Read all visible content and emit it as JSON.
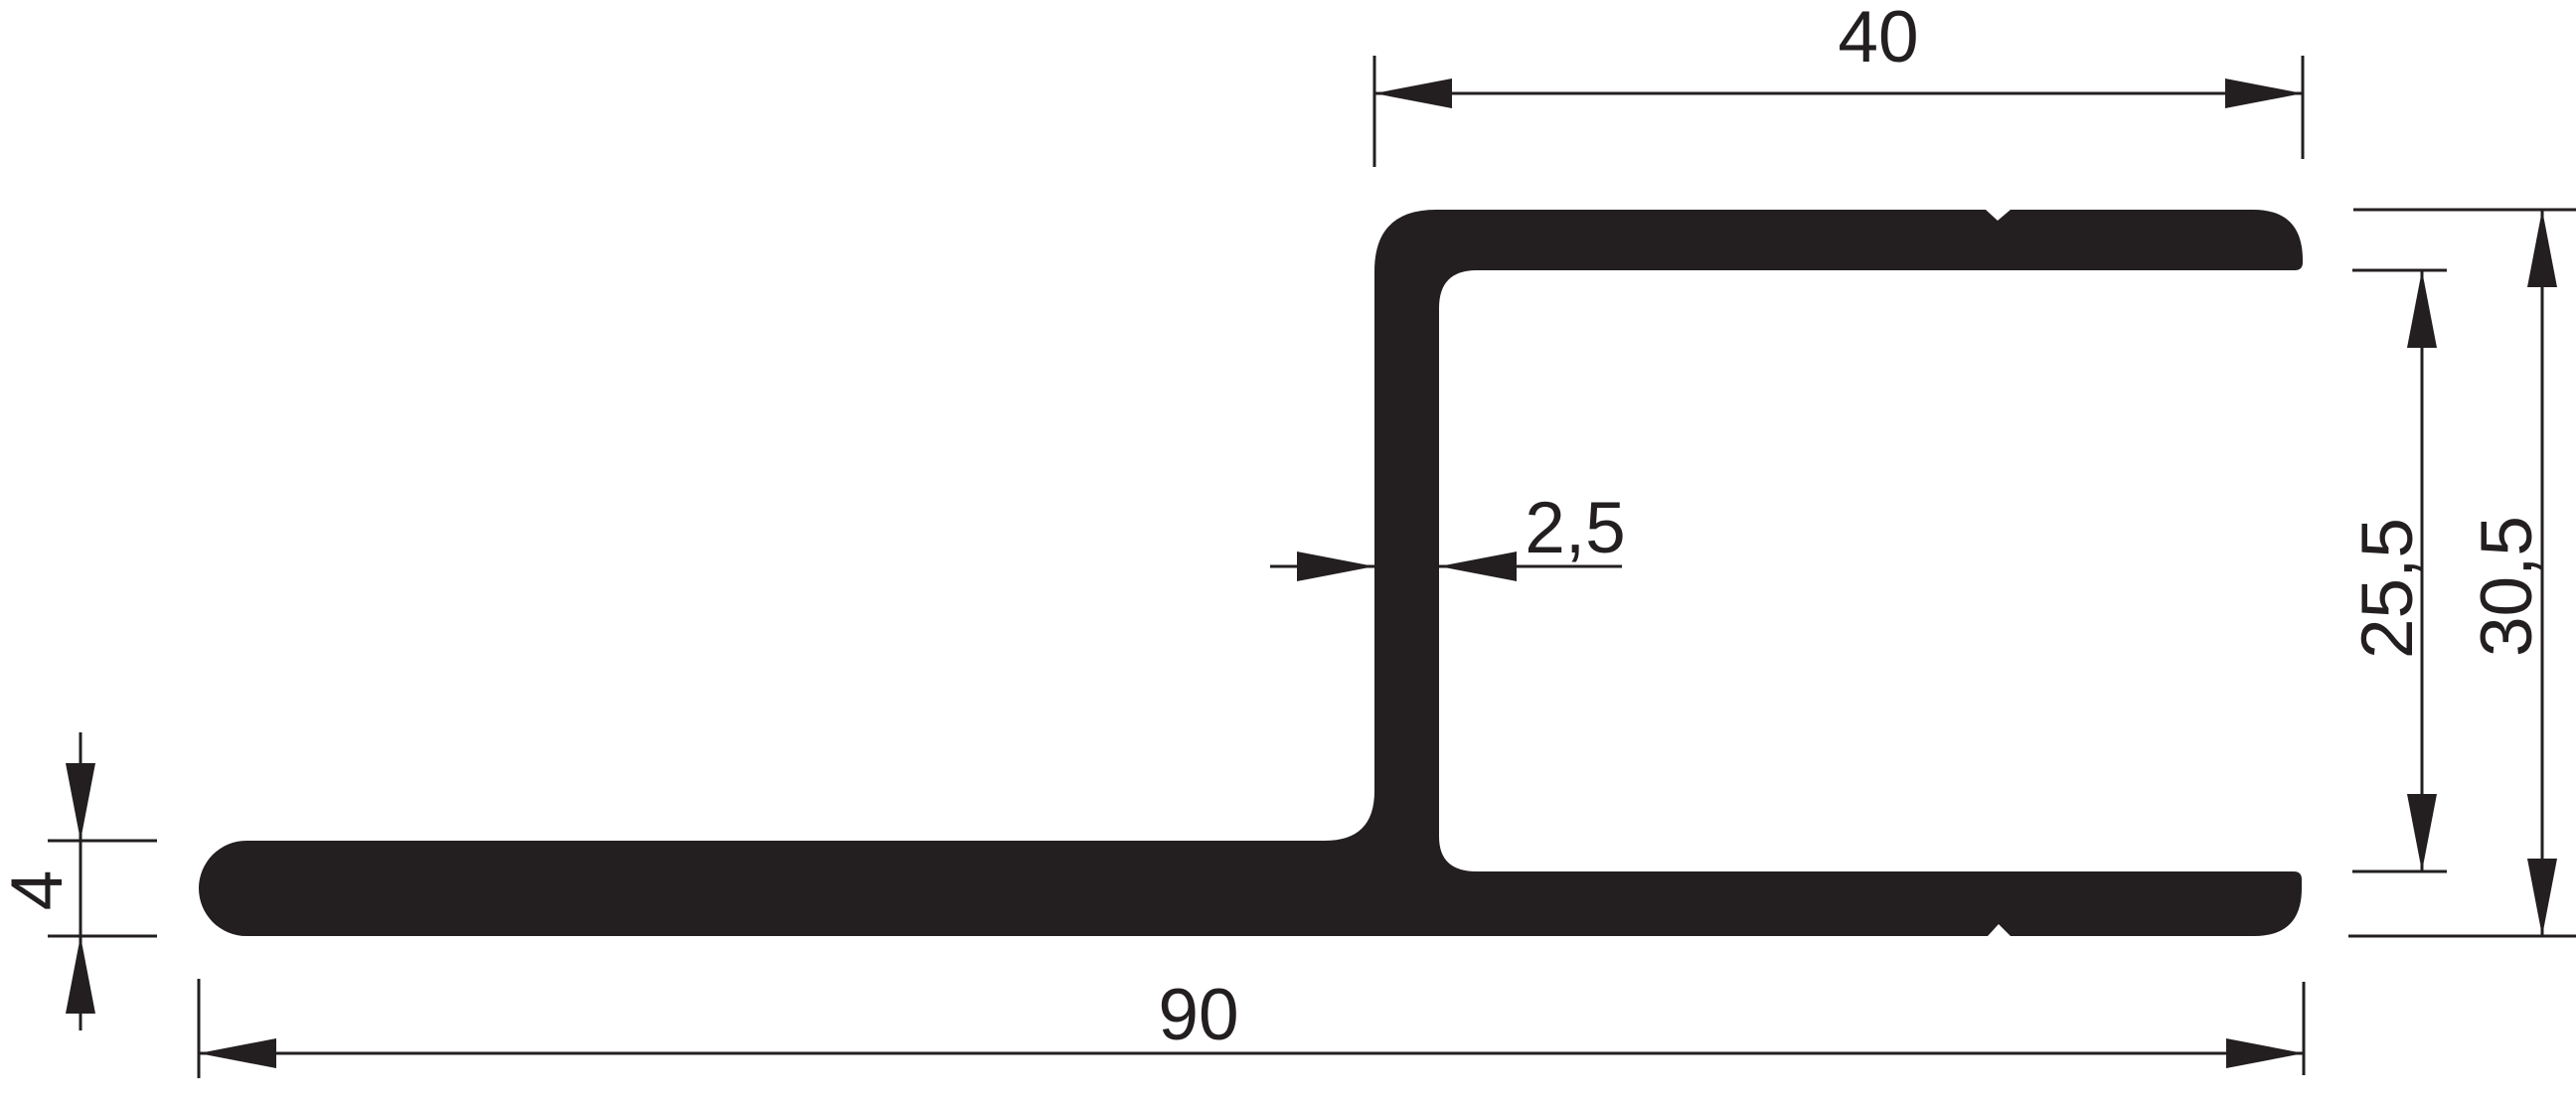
{
  "colors": {
    "ink": "#231f20",
    "bg": "#ffffff"
  },
  "drawing": {
    "kind": "profile-cross-section",
    "dims": {
      "flange_width": {
        "label": "40"
      },
      "wall_thickness": {
        "label": "2,5"
      },
      "inner_height": {
        "label": "25,5"
      },
      "overall_height": {
        "label": "30,5"
      },
      "base_thickness": {
        "label": "4"
      },
      "base_width": {
        "label": "90"
      }
    }
  }
}
